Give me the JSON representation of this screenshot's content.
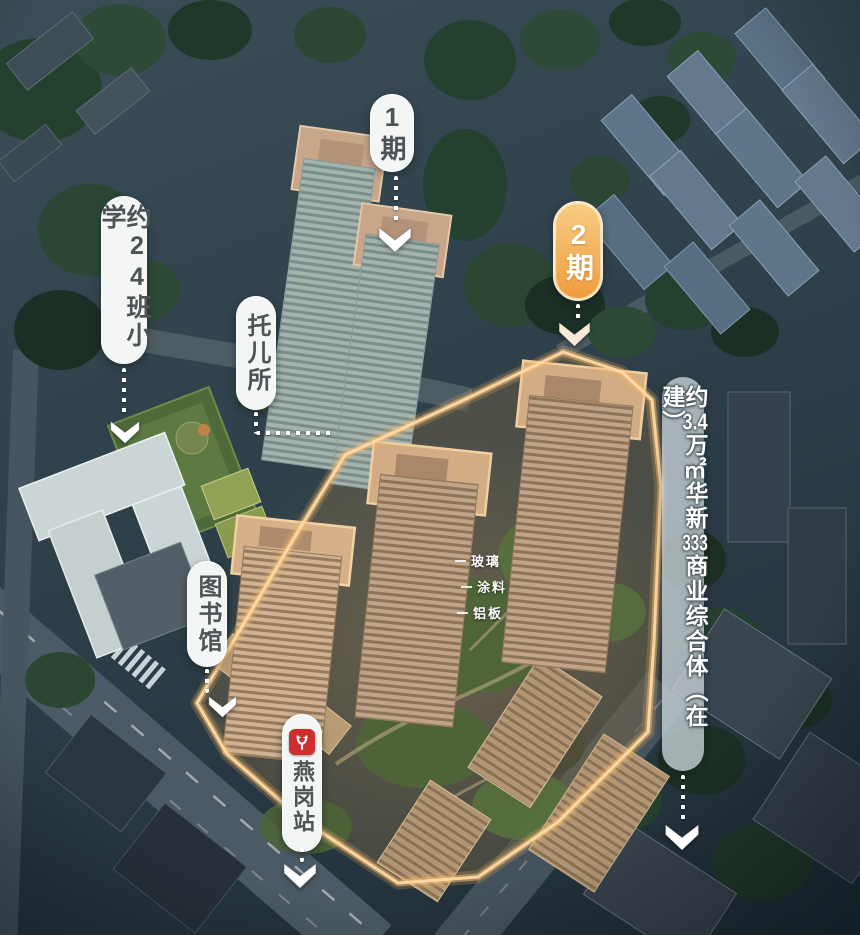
{
  "callouts": {
    "phase1": {
      "label": "1期"
    },
    "school": {
      "label": "约24班小学"
    },
    "nursery": {
      "label": "托儿所"
    },
    "phase2": {
      "label": "2期"
    },
    "commercial": {
      "full": "约3.4万㎡华新333商业综合体（在建）",
      "p1": "约",
      "n1": "3.4",
      "p2": "万",
      "sq": "㎡",
      "p3": "华新",
      "n2": "333",
      "p4": "商业综合体",
      "suffix": "（在建）"
    },
    "library": {
      "label": "图书馆"
    },
    "metro": {
      "label": "燕岗站",
      "icon": "guangzhou-metro-icon"
    },
    "materials": {
      "m1": "玻璃",
      "m2": "涂料",
      "m3": "铝板"
    }
  },
  "colors": {
    "phase2_pill": "#ee9d3e",
    "site_boundary_glow": "#f4bd76",
    "metro_logo_red": "#cf2e2e",
    "pill_background": "#f3f6f5",
    "pill_text": "#4e5456"
  }
}
